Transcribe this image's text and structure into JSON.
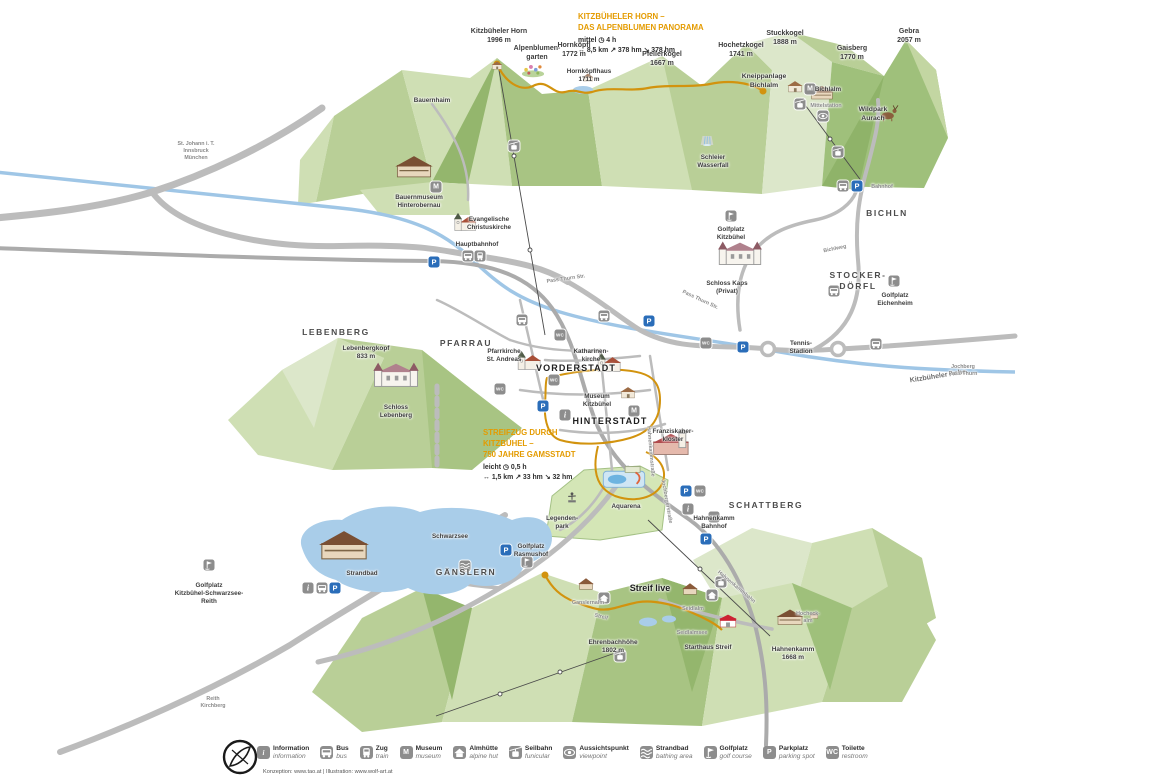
{
  "routes": [
    {
      "title": "KITZBÜHELER HORN –\nDAS ALPENBLUMEN PANORAMA",
      "difficulty": "mittel",
      "time": "4 h",
      "distance": "8,5 km",
      "ascent": "378 hm",
      "descent": "378 hm"
    },
    {
      "title": "STREIFZUG DURCH\nKITZBÜHEL –\n750 JAHRE GAMSSTADT",
      "difficulty": "leicht",
      "time": "0,5 h",
      "distance": "1,5 km",
      "ascent": "33 hm",
      "descent": "32 hm"
    }
  ],
  "map": {
    "labels": [
      {
        "n": "peak-kitzbueheler-horn",
        "t": "Kitzbüheler Horn\n1996 m",
        "x": 499,
        "y": 27,
        "c": "peak"
      },
      {
        "n": "label-alpenblumengarten",
        "t": "Alpenblumen-\ngarten",
        "x": 537,
        "y": 44,
        "c": "peak"
      },
      {
        "n": "peak-hornkoepfl",
        "t": "Hornköpfl\n1772 m",
        "x": 574,
        "y": 41,
        "c": "peak"
      },
      {
        "n": "label-hornkoepflhaus",
        "t": "Hornköpflhaus\n1711 m",
        "x": 589,
        "y": 68,
        "c": "tinyplace"
      },
      {
        "n": "peak-pfeilerkogel",
        "t": "Pfeilerkogel\n1667 m",
        "x": 662,
        "y": 50,
        "c": "peak"
      },
      {
        "n": "peak-hochetzkogel",
        "t": "Hochetzkogel\n1741 m",
        "x": 741,
        "y": 41,
        "c": "peak"
      },
      {
        "n": "peak-stuckkogel",
        "t": "Stuckkogel\n1888 m",
        "x": 785,
        "y": 29,
        "c": "peak"
      },
      {
        "n": "peak-gaisberg",
        "t": "Gaisberg\n1770 m",
        "x": 852,
        "y": 44,
        "c": "peak"
      },
      {
        "n": "peak-gebra",
        "t": "Gebra\n2057 m",
        "x": 909,
        "y": 27,
        "c": "peak"
      },
      {
        "n": "label-kneippanlage-bichlalm",
        "t": "Kneippanlage\nBichlalm",
        "x": 764,
        "y": 73,
        "c": "place"
      },
      {
        "n": "label-bichlalm",
        "t": "Bichlalm",
        "x": 828,
        "y": 86,
        "c": "tinyplace"
      },
      {
        "n": "label-mittelstation",
        "t": "Mittelstation",
        "x": 826,
        "y": 103,
        "c": "roadlbl"
      },
      {
        "n": "label-wildpark-aurach",
        "t": "Wildpark\nAurach",
        "x": 873,
        "y": 106,
        "c": "place"
      },
      {
        "n": "label-schleier-wasserfall",
        "t": "Schleier\nWasserfall",
        "x": 713,
        "y": 154,
        "c": "tinyplace"
      },
      {
        "n": "label-bauernhaim",
        "t": "Bauernhaim",
        "x": 432,
        "y": 97,
        "c": "tinyplace"
      },
      {
        "n": "label-bauernmuseum",
        "t": "Bauernmuseum\nHinterobernau",
        "x": 419,
        "y": 194,
        "c": "tinyplace"
      },
      {
        "n": "label-christuskirche",
        "t": "Evangelische\nChristuskirche",
        "x": 489,
        "y": 216,
        "c": "tinyplace"
      },
      {
        "n": "label-hauptbahnhof",
        "t": "Hauptbahnhof",
        "x": 477,
        "y": 241,
        "c": "tinyplace"
      },
      {
        "n": "region-bichln",
        "t": "BICHLN",
        "x": 887,
        "y": 208,
        "c": "region"
      },
      {
        "n": "label-golfplatz-kitzbuehel",
        "t": "Golfplatz\nKitzbühel",
        "x": 731,
        "y": 226,
        "c": "tinyplace"
      },
      {
        "n": "label-schloss-kaps",
        "t": "Schloss Kaps\n(Privat)",
        "x": 727,
        "y": 280,
        "c": "tinyplace"
      },
      {
        "n": "region-stockerdoerfl",
        "t": "STOCKER-\nDÖRFL",
        "x": 858,
        "y": 270,
        "c": "region"
      },
      {
        "n": "label-golfplatz-eichenheim",
        "t": "Golfplatz\nEichenheim",
        "x": 895,
        "y": 292,
        "c": "tinyplace"
      },
      {
        "n": "label-tennis-stadion",
        "t": "Tennis-\nStadion",
        "x": 801,
        "y": 340,
        "c": "tinyplace"
      },
      {
        "n": "region-lebenberg",
        "t": "LEBENBERG",
        "x": 336,
        "y": 327,
        "c": "region"
      },
      {
        "n": "region-pfarrau",
        "t": "PFARRAU",
        "x": 466,
        "y": 338,
        "c": "region"
      },
      {
        "n": "peak-lebenbergkopf",
        "t": "Lebenbergkopf\n833 m",
        "x": 366,
        "y": 345,
        "c": "peaksm"
      },
      {
        "n": "label-schloss-lebenberg",
        "t": "Schloss\nLebenberg",
        "x": 396,
        "y": 404,
        "c": "tinyplace"
      },
      {
        "n": "label-pfarrkirche",
        "t": "Pfarrkirche\nSt. Andreas",
        "x": 504,
        "y": 348,
        "c": "tinyplace"
      },
      {
        "n": "label-katharinenkirche",
        "t": "Katharinen-\nkirche",
        "x": 591,
        "y": 348,
        "c": "tinyplace"
      },
      {
        "n": "town-vorderstadt",
        "t": "VORDERSTADT",
        "x": 576,
        "y": 363,
        "c": "town"
      },
      {
        "n": "label-museum-kitzbuehel",
        "t": "Museum\nKitzbühel",
        "x": 597,
        "y": 393,
        "c": "tinyplace"
      },
      {
        "n": "town-hinterstadt",
        "t": "HINTERSTADT",
        "x": 610,
        "y": 416,
        "c": "town"
      },
      {
        "n": "label-franziskanerkloster",
        "t": "Franziskaner-\nkloster",
        "x": 673,
        "y": 428,
        "c": "tinyplace"
      },
      {
        "n": "label-aquarena",
        "t": "Aquarena",
        "x": 626,
        "y": 503,
        "c": "tinyplace"
      },
      {
        "n": "label-legendenpark",
        "t": "Legenden-\npark",
        "x": 562,
        "y": 515,
        "c": "tinyplace"
      },
      {
        "n": "label-hahnenkamm-bahnhof",
        "t": "Hahnenkamm\nBahnhof",
        "x": 714,
        "y": 515,
        "c": "tinyplace"
      },
      {
        "n": "region-schattberg",
        "t": "SCHATTBERG",
        "x": 766,
        "y": 500,
        "c": "region"
      },
      {
        "n": "label-schwarzsee",
        "t": "Schwarzsee",
        "x": 450,
        "y": 533,
        "c": "tinyplace"
      },
      {
        "n": "label-strandbad",
        "t": "Strandbad",
        "x": 362,
        "y": 570,
        "c": "tinyplace"
      },
      {
        "n": "label-golfplatz-schwarzsee",
        "t": "Golfplatz\nKitzbühel-Schwarzsee-\nReith",
        "x": 209,
        "y": 582,
        "c": "tinyplace"
      },
      {
        "n": "region-gaenslern",
        "t": "GÄNSLERN",
        "x": 466,
        "y": 567,
        "c": "region"
      },
      {
        "n": "label-golfplatz-rasmushof",
        "t": "Golfplatz\nRasmushof",
        "x": 531,
        "y": 543,
        "c": "tinyplace"
      },
      {
        "n": "label-streif-live",
        "t": "Streif live",
        "x": 650,
        "y": 583,
        "c": "streif"
      },
      {
        "n": "label-ganslernalm",
        "t": "Ganslernalm",
        "x": 588,
        "y": 600,
        "c": "roadlbl"
      },
      {
        "n": "label-seidlalm",
        "t": "Seidlalm",
        "x": 693,
        "y": 606,
        "c": "roadlbl"
      },
      {
        "n": "label-seidlalmsee",
        "t": "Seidlalmsee",
        "x": 692,
        "y": 630,
        "c": "roadlbl"
      },
      {
        "n": "peak-ehrenbachhoehe",
        "t": "Ehrenbachhöhe\n1802 m",
        "x": 613,
        "y": 639,
        "c": "peaksm"
      },
      {
        "n": "label-starthaus-streif",
        "t": "Starthaus Streif",
        "x": 708,
        "y": 644,
        "c": "tinyplace"
      },
      {
        "n": "peak-hahnenkamm",
        "t": "Hahnenkamm\n1668 m",
        "x": 793,
        "y": 646,
        "c": "peaksm"
      },
      {
        "n": "label-hocheckalm",
        "t": "Hocheck-\nalm",
        "x": 808,
        "y": 611,
        "c": "roadlbl"
      },
      {
        "n": "label-kitzbueheler-ache",
        "t": "Kitzbüheler Ache",
        "x": 938,
        "y": 372,
        "c": "water",
        "r": -9
      },
      {
        "n": "sign-st-johann",
        "t": "St. Johann i. T.\nInnsbruck\nMünchen",
        "x": 196,
        "y": 141,
        "c": "roadlbl"
      },
      {
        "n": "sign-reith-kirchberg",
        "t": "Reith\nKirchberg",
        "x": 213,
        "y": 696,
        "c": "roadlbl"
      },
      {
        "n": "road-pass-thurn-str-1",
        "t": "Pass Thurn Str.",
        "x": 566,
        "y": 276,
        "c": "roadlbl",
        "r": -8
      },
      {
        "n": "road-pass-thurn-str-2",
        "t": "Pass Thurn Str.",
        "x": 700,
        "y": 297,
        "c": "roadlbl",
        "r": 25
      },
      {
        "n": "road-bichlweg",
        "t": "Bichlweg",
        "x": 835,
        "y": 246,
        "c": "roadlbl",
        "r": -12
      },
      {
        "n": "road-hahnenkammstrasse",
        "t": "Hahnenkammstraße",
        "x": 650,
        "y": 448,
        "c": "roadlbl",
        "r": 85
      },
      {
        "n": "road-jochbergerstrasse",
        "t": "Jochbergerstraße",
        "x": 666,
        "y": 498,
        "c": "roadlbl",
        "r": 80
      },
      {
        "n": "road-hahnenkammbahn",
        "t": "Hahnenkammbahn",
        "x": 736,
        "y": 584,
        "c": "roadlbl",
        "r": 40
      },
      {
        "n": "road-streif",
        "t": "Streif",
        "x": 601,
        "y": 614,
        "c": "roadlbl",
        "r": 14
      },
      {
        "n": "sign-jochberg-pass-thurn",
        "t": "Jochberg\nPass Thurn",
        "x": 963,
        "y": 364,
        "c": "roadlbl"
      },
      {
        "n": "label-bahnhof-bichln",
        "t": "Bahnhof",
        "x": 882,
        "y": 184,
        "c": "roadlbl"
      }
    ],
    "badges": [
      {
        "n": "parking-icon",
        "k": "p",
        "g": "P",
        "x": 434,
        "y": 262
      },
      {
        "n": "parking-icon",
        "k": "p",
        "g": "P",
        "x": 543,
        "y": 406
      },
      {
        "n": "parking-icon",
        "k": "p",
        "g": "P",
        "x": 649,
        "y": 321
      },
      {
        "n": "parking-icon",
        "k": "p",
        "g": "P",
        "x": 743,
        "y": 347
      },
      {
        "n": "parking-icon",
        "k": "p",
        "g": "P",
        "x": 857,
        "y": 186
      },
      {
        "n": "parking-icon",
        "k": "p",
        "g": "P",
        "x": 686,
        "y": 491
      },
      {
        "n": "parking-icon",
        "k": "p",
        "g": "P",
        "x": 706,
        "y": 539
      },
      {
        "n": "parking-icon",
        "k": "p",
        "g": "P",
        "x": 335,
        "y": 588
      },
      {
        "n": "parking-icon",
        "k": "p",
        "g": "P",
        "x": 506,
        "y": 550
      },
      {
        "n": "toilet-icon",
        "k": "wc",
        "g": "WC",
        "x": 500,
        "y": 389
      },
      {
        "n": "toilet-icon",
        "k": "wc",
        "g": "WC",
        "x": 554,
        "y": 380
      },
      {
        "n": "toilet-icon",
        "k": "wc",
        "g": "WC",
        "x": 706,
        "y": 343
      },
      {
        "n": "toilet-icon",
        "k": "wc",
        "g": "WC",
        "x": 700,
        "y": 491
      },
      {
        "n": "toilet-icon",
        "k": "wc",
        "g": "WC",
        "x": 714,
        "y": 517
      },
      {
        "n": "toilet-icon",
        "k": "wc",
        "g": "WC",
        "x": 560,
        "y": 335
      },
      {
        "n": "bus-icon",
        "k": "bus",
        "x": 468,
        "y": 256
      },
      {
        "n": "bus-icon",
        "k": "bus",
        "x": 843,
        "y": 186
      },
      {
        "n": "bus-icon",
        "k": "bus",
        "x": 322,
        "y": 588
      },
      {
        "n": "bus-icon",
        "k": "bus",
        "x": 834,
        "y": 291
      },
      {
        "n": "bus-icon",
        "k": "bus",
        "x": 522,
        "y": 320
      },
      {
        "n": "bus-icon",
        "k": "bus",
        "x": 604,
        "y": 316
      },
      {
        "n": "bus-icon",
        "k": "bus",
        "x": 876,
        "y": 344
      },
      {
        "n": "train-icon",
        "k": "train",
        "x": 480,
        "y": 256
      },
      {
        "n": "information-icon",
        "k": "i",
        "g": "i",
        "x": 308,
        "y": 588
      },
      {
        "n": "information-icon",
        "k": "i",
        "g": "i",
        "x": 688,
        "y": 509
      },
      {
        "n": "information-icon",
        "k": "i",
        "g": "i",
        "x": 565,
        "y": 415
      },
      {
        "n": "museum-icon",
        "k": "m",
        "g": "M",
        "x": 436,
        "y": 187
      },
      {
        "n": "museum-icon",
        "k": "m",
        "g": "M",
        "x": 634,
        "y": 411
      },
      {
        "n": "museum-icon",
        "k": "m",
        "g": "M",
        "x": 810,
        "y": 89
      },
      {
        "n": "golf-icon",
        "k": "golf",
        "x": 731,
        "y": 216
      },
      {
        "n": "golf-icon",
        "k": "golf",
        "x": 894,
        "y": 281
      },
      {
        "n": "golf-icon",
        "k": "golf",
        "x": 209,
        "y": 565
      },
      {
        "n": "golf-icon",
        "k": "golf",
        "x": 527,
        "y": 562
      },
      {
        "n": "funicular-icon",
        "k": "funicular",
        "x": 514,
        "y": 146
      },
      {
        "n": "funicular-icon",
        "k": "funicular",
        "x": 800,
        "y": 104
      },
      {
        "n": "funicular-icon",
        "k": "funicular",
        "x": 721,
        "y": 582
      },
      {
        "n": "funicular-icon",
        "k": "funicular",
        "x": 838,
        "y": 152
      },
      {
        "n": "funicular-icon",
        "k": "funicular",
        "x": 620,
        "y": 656
      },
      {
        "n": "viewpoint-icon",
        "k": "viewpoint",
        "x": 823,
        "y": 116
      },
      {
        "n": "alpine-hut-icon",
        "k": "hut",
        "x": 604,
        "y": 598
      },
      {
        "n": "alpine-hut-icon",
        "k": "hut",
        "x": 712,
        "y": 595
      },
      {
        "n": "bathing-icon",
        "k": "strandbad",
        "x": 465,
        "y": 566
      }
    ],
    "buildings": [
      {
        "n": "bld-hornbahn-station",
        "s": "house",
        "x": 497,
        "y": 70,
        "w": 16
      },
      {
        "n": "bld-alpenblumengarten",
        "s": "flowers",
        "x": 533,
        "y": 78,
        "w": 28
      },
      {
        "n": "bld-hornkoepflhaus",
        "s": "hut",
        "x": 588,
        "y": 83,
        "w": 18
      },
      {
        "n": "bld-kneippanlage",
        "s": "house",
        "x": 795,
        "y": 93,
        "w": 22
      },
      {
        "n": "bld-bichlalm",
        "s": "chalet",
        "x": 822,
        "y": 101,
        "w": 26
      },
      {
        "n": "bld-wildpark-deer",
        "s": "deer",
        "x": 889,
        "y": 122,
        "w": 28
      },
      {
        "n": "bld-schleier-wasserfall",
        "s": "waterfall",
        "x": 707,
        "y": 147,
        "w": 18
      },
      {
        "n": "bld-bauernmuseum",
        "s": "chalet",
        "x": 414,
        "y": 180,
        "w": 42
      },
      {
        "n": "bld-christuskirche",
        "s": "church",
        "x": 466,
        "y": 233,
        "w": 32
      },
      {
        "n": "bld-schloss-kaps",
        "s": "castle",
        "x": 740,
        "y": 268,
        "w": 46
      },
      {
        "n": "bld-schloss-lebenberg",
        "s": "castle",
        "x": 396,
        "y": 390,
        "w": 48
      },
      {
        "n": "bld-pfarrkirche",
        "s": "church",
        "x": 530,
        "y": 372,
        "w": 34
      },
      {
        "n": "bld-katharinenkirche",
        "s": "church",
        "x": 610,
        "y": 374,
        "w": 34
      },
      {
        "n": "bld-museum-kitzbuehel",
        "s": "house",
        "x": 628,
        "y": 399,
        "w": 22
      },
      {
        "n": "bld-franziskanerkloster",
        "s": "kloster",
        "x": 672,
        "y": 458,
        "w": 46
      },
      {
        "n": "bld-aquarena",
        "s": "pool",
        "x": 624,
        "y": 492,
        "w": 46
      },
      {
        "n": "bld-legendenpark",
        "s": "statue",
        "x": 572,
        "y": 504,
        "w": 22
      },
      {
        "n": "bld-strandbad",
        "s": "chalet",
        "x": 344,
        "y": 563,
        "w": 56
      },
      {
        "n": "bld-ganslernalm",
        "s": "hut",
        "x": 586,
        "y": 592,
        "w": 26
      },
      {
        "n": "bld-seidlalm",
        "s": "hut",
        "x": 690,
        "y": 597,
        "w": 26
      },
      {
        "n": "bld-starthaus-streif",
        "s": "starthaus",
        "x": 728,
        "y": 629,
        "w": 26
      },
      {
        "n": "bld-hahnenkamm-station",
        "s": "chalet",
        "x": 790,
        "y": 627,
        "w": 30
      },
      {
        "n": "bld-hocheckalm",
        "s": "hut",
        "x": 814,
        "y": 620,
        "w": 16
      }
    ]
  },
  "legend": {
    "items": [
      {
        "de": "Information",
        "en": "information",
        "k": "i",
        "g": "i"
      },
      {
        "de": "Bus",
        "en": "bus",
        "k": "bus"
      },
      {
        "de": "Zug",
        "en": "train",
        "k": "train"
      },
      {
        "de": "Museum",
        "en": "museum",
        "k": "m",
        "g": "M"
      },
      {
        "de": "Almhütte",
        "en": "alpine hut",
        "k": "hut"
      },
      {
        "de": "Seilbahn",
        "en": "funicular",
        "k": "funicular"
      },
      {
        "de": "Aussichtspunkt",
        "en": "viewpoint",
        "k": "viewpoint"
      },
      {
        "de": "Strandbad",
        "en": "bathing area",
        "k": "strandbad"
      },
      {
        "de": "Golfplatz",
        "en": "golf course",
        "k": "golf"
      },
      {
        "de": "Parkplatz",
        "en": "parking spot",
        "k": "p",
        "g": "P"
      },
      {
        "de": "Toilette",
        "en": "restroom",
        "k": "wc",
        "g": "WC"
      }
    ]
  },
  "credits": "Konzeption: www.tao.at | Illustration: www.wolf-art.at",
  "colors": {
    "trail_orange": "#d2930e",
    "route_title_orange": "#e49b00",
    "parking_blue": "#2a6db9",
    "river_blue": "#9fc6e6",
    "lake_blue": "#a9cde9",
    "terrain_green": "#c6d8a8",
    "road_gray": "#bcbcbc"
  }
}
